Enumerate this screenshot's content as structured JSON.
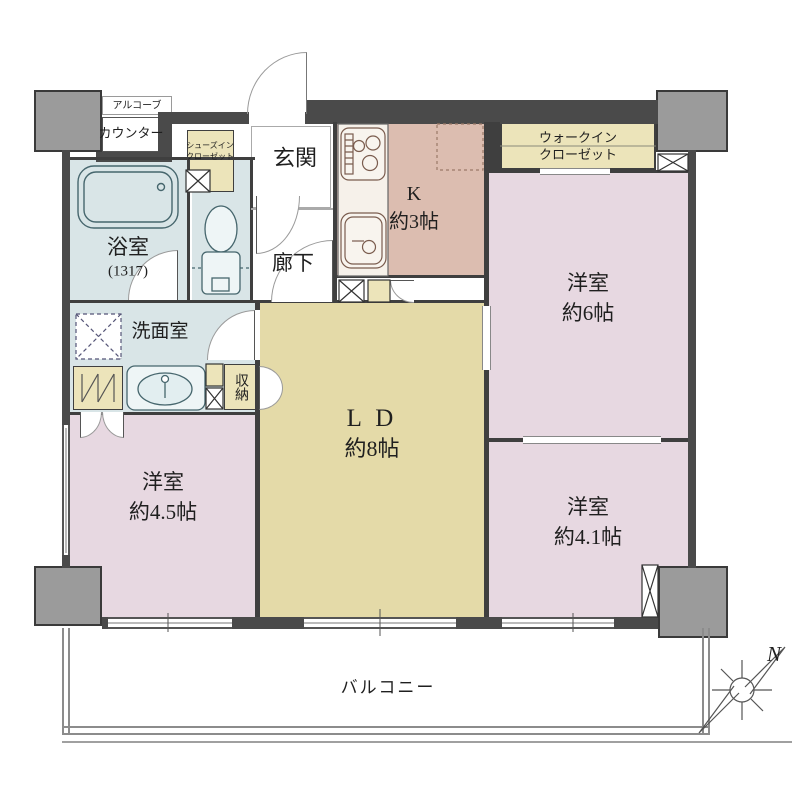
{
  "title": "マンション間取り図 3LDK",
  "colors": {
    "wall_gray": "#4a4a4a",
    "pillar_gray": "#9b9b9b",
    "bath_blue": "#d9e5e7",
    "kitchen_pink": "#dcbdb0",
    "bedroom_pink": "#e7d8e1",
    "ld_yellow": "#e4daa8",
    "closet_cream": "#ece4ba"
  },
  "labels": {
    "alcove": "アルコーブ",
    "counter": "カウンター",
    "shoes_closet_l1": "シューズイン",
    "shoes_closet_l2": "クローゼット",
    "entrance": "玄関",
    "bath": "浴室",
    "bath_size": "(1317)",
    "corridor": "廊下",
    "kitchen_l1": "K",
    "kitchen_l2": "約3帖",
    "wic_l1": "ウォークイン",
    "wic_l2": "クローゼット",
    "west6_l1": "洋室",
    "west6_l2": "約6帖",
    "washroom": "洗面室",
    "storage": "収納",
    "ld_l1": "L D",
    "ld_l2": "約8帖",
    "west45_l1": "洋室",
    "west45_l2": "約4.5帖",
    "west41_l1": "洋室",
    "west41_l2": "約4.1帖",
    "balcony": "バルコニー",
    "compass_north": "N"
  }
}
